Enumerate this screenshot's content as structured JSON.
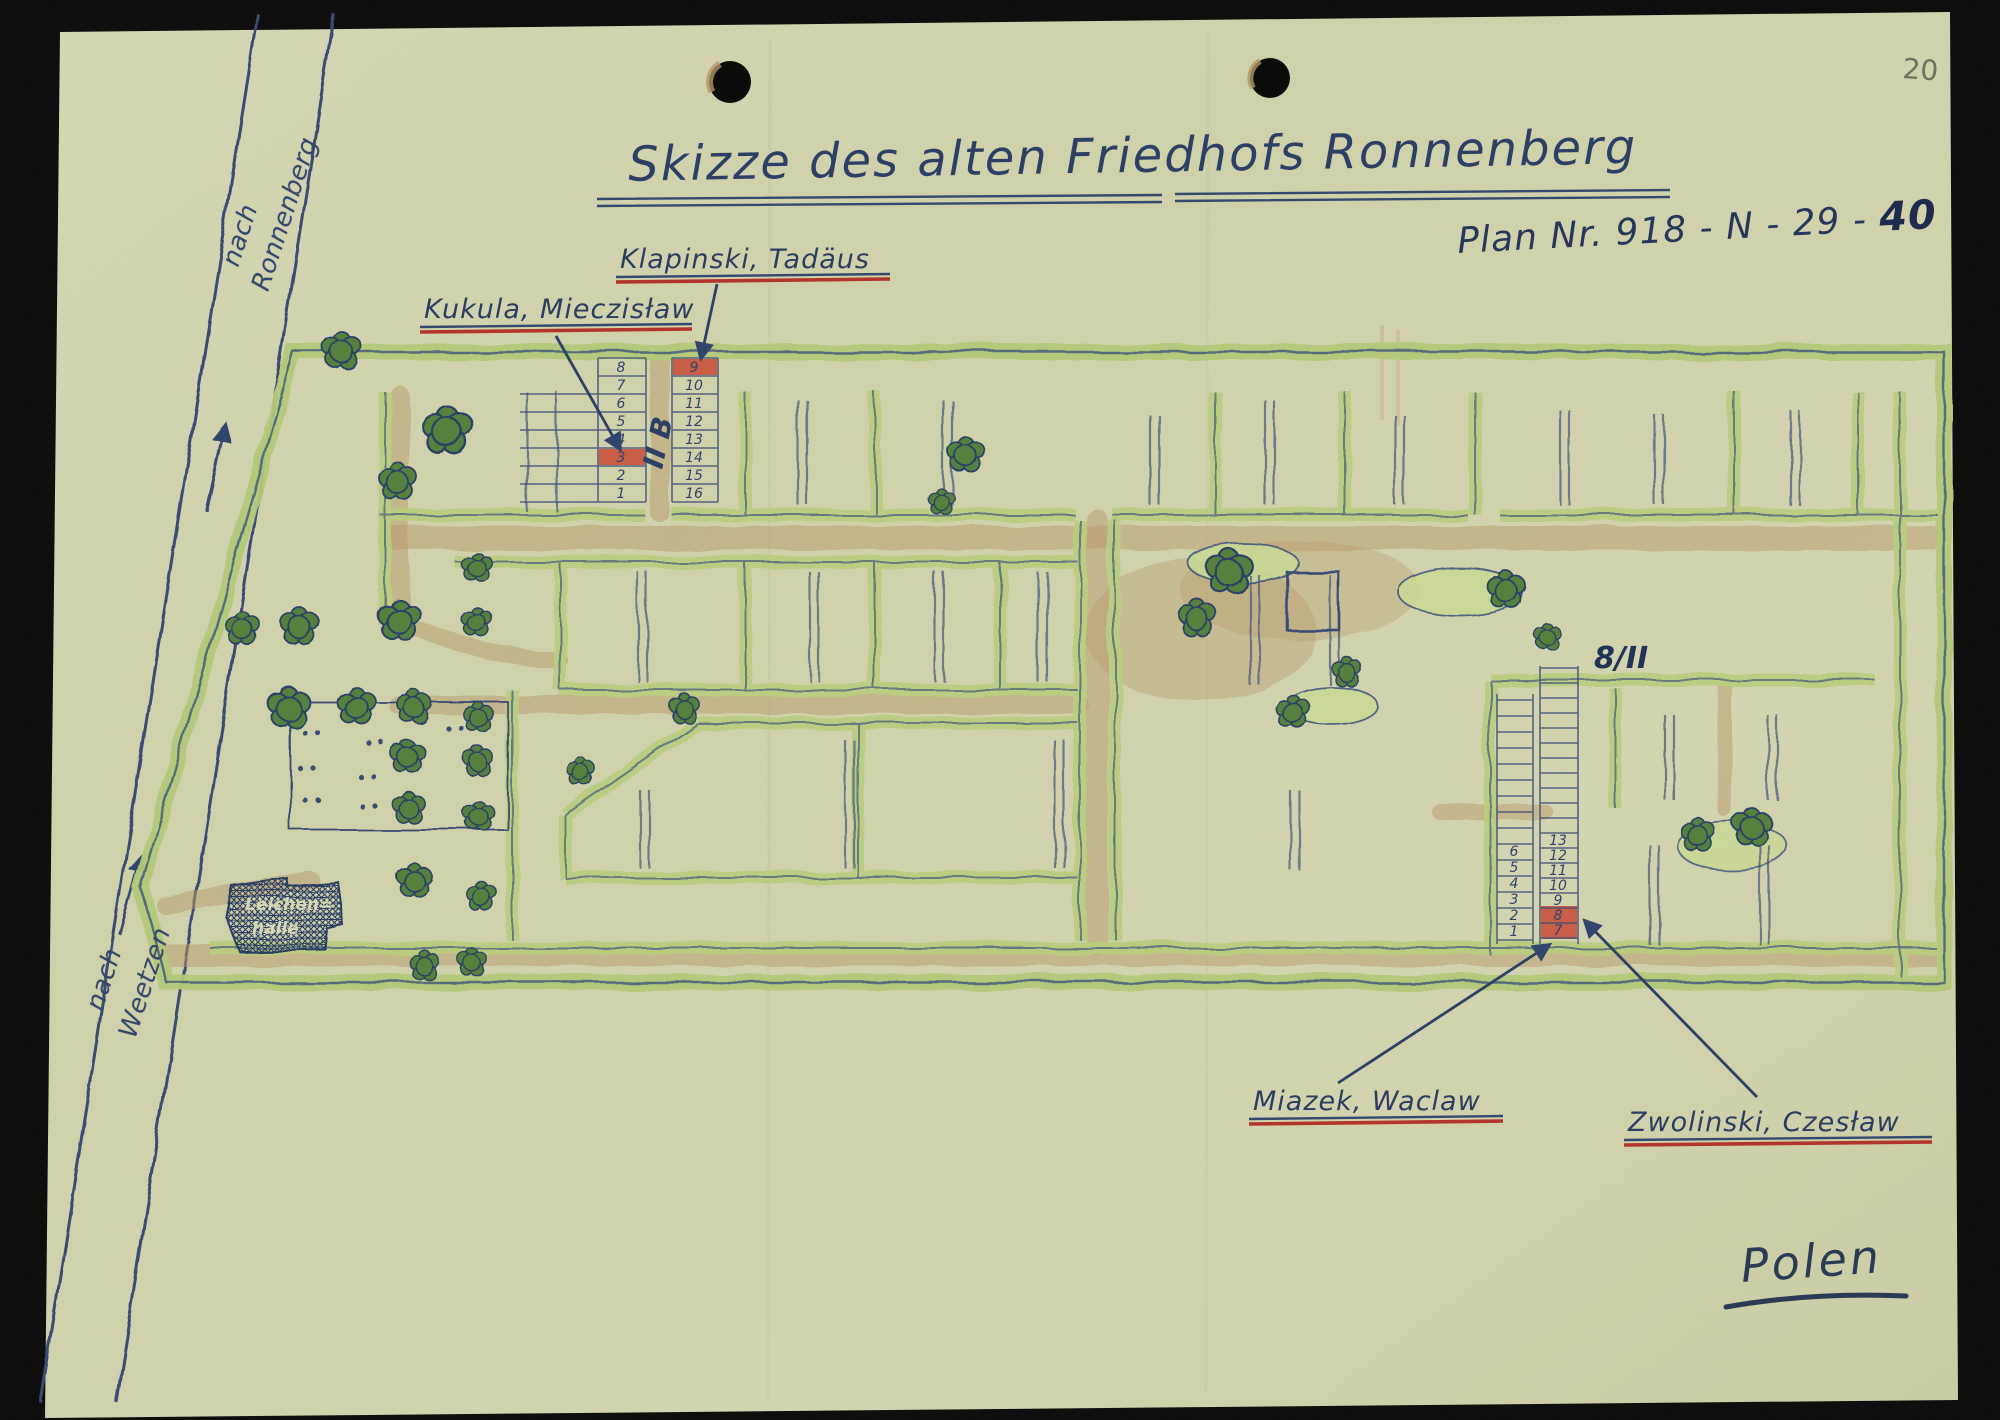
{
  "page": {
    "title": "Skizze des alten Friedhofs Ronnenberg",
    "plan_prefix": "Plan Nr. 918 - N - 29 - ",
    "plan_suffix": "40",
    "number": "20",
    "signature": "Polen"
  },
  "roads": {
    "ronnenberg": {
      "prefix": "nach",
      "name": "Ronnenberg"
    },
    "weetzen": {
      "prefix": "nach",
      "name": "Weetzen"
    }
  },
  "buildings": {
    "morgue": {
      "line1": "Leichen=",
      "line2": "halle"
    }
  },
  "sections": {
    "left_path_label": "II B",
    "right_label": "8/II"
  },
  "graves": {
    "names": [
      {
        "name": "Klapinski, Tadäus",
        "grave": "9"
      },
      {
        "name": "Kukula, Mieczisław",
        "grave": "3"
      },
      {
        "name": "Miazek, Waclaw",
        "grave": "8"
      },
      {
        "name": "Zwolinski, Czesław",
        "grave": "7"
      }
    ],
    "left_block": {
      "col1": [
        "8",
        "7",
        "6",
        "5",
        "4",
        "3",
        "2",
        "1"
      ],
      "col2": [
        "9",
        "10",
        "11",
        "12",
        "13",
        "14",
        "15",
        "16"
      ],
      "highlighted": [
        "3",
        "9"
      ]
    },
    "right_block": {
      "col1": [
        "6",
        "5",
        "4",
        "3",
        "2",
        "1"
      ],
      "col2": [
        "13",
        "12",
        "11",
        "10",
        "9",
        "8",
        "7"
      ],
      "highlighted": [
        "8",
        "7"
      ]
    }
  },
  "colors": {
    "background": "#0a0a0a",
    "paper": "#d2d3ae",
    "ink": "#3a4c74",
    "hedge": "#b9cc80",
    "tree": "#56813d",
    "path": "#b79a6b",
    "highlight_red": "#c84a35",
    "underline_red": "#b2342a",
    "pencil": "#70705f"
  }
}
